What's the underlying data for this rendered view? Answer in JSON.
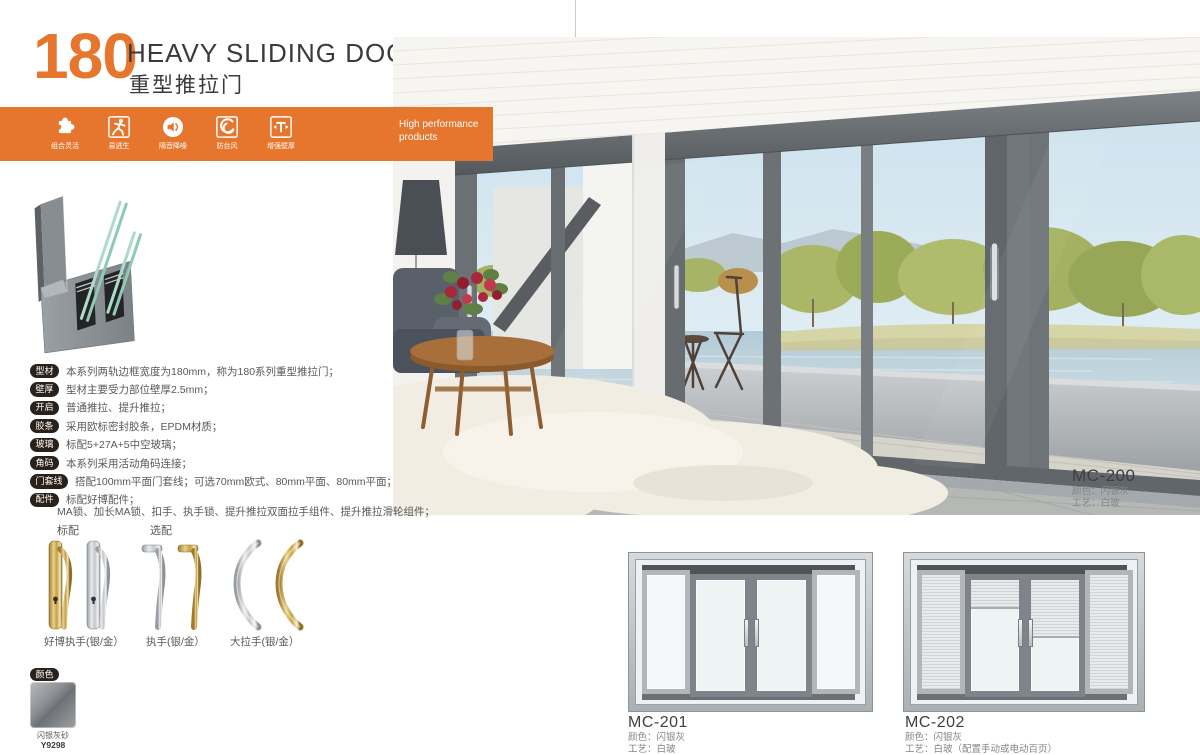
{
  "header": {
    "series_number": "180",
    "title_en": "HEAVY SLIDING DOOR",
    "title_cn": "重型推拉门",
    "accent_color": "#E6762D"
  },
  "banner": {
    "tagline_l1": "High performance",
    "tagline_l2": "products",
    "features": [
      {
        "icon": "puzzle-icon",
        "label": "组合灵活"
      },
      {
        "icon": "escape-runner-icon",
        "label": "易逃生"
      },
      {
        "icon": "sound-insulation-icon",
        "label": "隔音降噪"
      },
      {
        "icon": "typhoon-icon",
        "label": "防台风"
      },
      {
        "icon": "wall-thickness-icon",
        "label": "增强壁厚"
      }
    ]
  },
  "specs": {
    "rows": [
      {
        "tag": "型材",
        "text": "本系列两轨边框宽度为180mm，称为180系列重型推拉门；"
      },
      {
        "tag": "壁厚",
        "text": "型材主要受力部位壁厚2.5mm；"
      },
      {
        "tag": "开启",
        "text": "普通推拉、提升推拉；"
      },
      {
        "tag": "胶条",
        "text": "采用欧标密封胶条，EPDM材质；"
      },
      {
        "tag": "玻璃",
        "text": "标配5+27A+5中空玻璃；"
      },
      {
        "tag": "角码",
        "text": "本系列采用活动角码连接；"
      },
      {
        "tag": "门套线",
        "text": "搭配100mm平面门套线；可选70mm欧式、80mm平面、80mm平面；"
      },
      {
        "tag": "配件",
        "text": "标配好博配件；"
      }
    ],
    "accessories_note": "MA锁、加长MA锁、扣手、执手锁、提升推拉双面拉手组件、提升推拉滑轮组件；"
  },
  "hardware": {
    "standard_label": "标配",
    "optional_label": "选配",
    "items": [
      {
        "caption": "好博执手(银/金）",
        "finishes": "gold-silver"
      },
      {
        "caption": "执手(银/金）",
        "finishes": "silver-gold"
      },
      {
        "caption": "大拉手(银/金）",
        "finishes": "silver-gold"
      }
    ]
  },
  "colors": {
    "tag": "颜色",
    "name": "闪银灰砂",
    "code": "Y9298",
    "swatch_hex": "#84888c"
  },
  "photo": {
    "model": "MC-200",
    "color_line": "颜色：闪银灰",
    "craft_line": "工艺：白玻"
  },
  "products": [
    {
      "model": "MC-201",
      "color_line": "颜色：闪银灰",
      "craft_line": "工艺：白玻"
    },
    {
      "model": "MC-202",
      "color_line": "颜色：闪银灰",
      "craft_line": "工艺：白玻（配置手动或电动百页）"
    }
  ]
}
